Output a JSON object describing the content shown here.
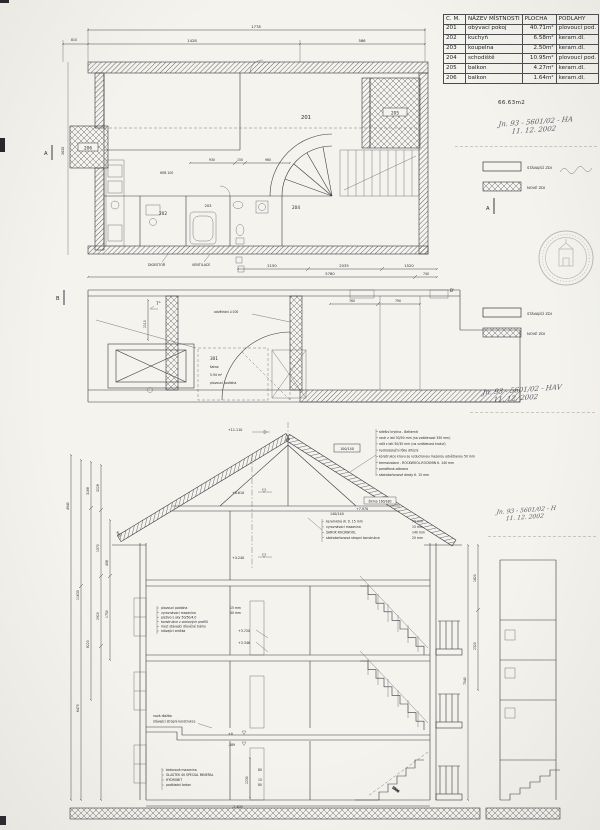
{
  "table": {
    "headers": [
      "C. M.",
      "NÁZEV MÍSTNOSTI",
      "PLOCHA",
      "PODLAHY"
    ],
    "rows": [
      {
        "no": "201",
        "name": "obývací pokoj",
        "area": "40.71m²",
        "floor": "plovoucí pod."
      },
      {
        "no": "202",
        "name": "kuchyň",
        "area": "6.58m²",
        "floor": "keram.dl."
      },
      {
        "no": "203",
        "name": "koupelna",
        "area": "2.50m²",
        "floor": "keram.dl."
      },
      {
        "no": "204",
        "name": "schodiště",
        "area": "10.95m²",
        "floor": "plovoucí pod."
      },
      {
        "no": "205",
        "name": "balkon",
        "area": "4.27m²",
        "floor": "keram.dl."
      },
      {
        "no": "206",
        "name": "balkon",
        "area": "1.64m²",
        "floor": "keram.dl."
      }
    ],
    "total": "66.63m2"
  },
  "legend": {
    "existing": "STÁVAJÍCÍ ZDI",
    "new": "NOVÉ ZDI"
  },
  "notes": {
    "hw1a": "Jn. 93 - 5601/02 - HA",
    "hw1b": "11. 12. 2002",
    "hw2a": "Jn. 93 - 5601/02 - HAV",
    "hw2b": "11. 12. 2002",
    "hw3a": "Jn. 93 - 5601/02 - H",
    "hw3b": "11. 12. 2002"
  },
  "plan1": {
    "rooms": {
      "r201": "201",
      "r202": "202",
      "r203": "203",
      "r204": "204",
      "r205": "205",
      "r206": "206"
    },
    "labels": {
      "digestor": "DIGESTOŘ",
      "ventilace": "VENTILACE",
      "heb": "HEB 100"
    },
    "dims": {
      "top1": "1778",
      "top2a": "1428",
      "top2b": "586",
      "left_top": "810",
      "left_v": "1620",
      "i1": "930",
      "i2": "150",
      "i3": "960",
      "b1": "2150",
      "b2": "2035",
      "b3": "1520",
      "b4": "5780",
      "b5": "740"
    },
    "marker_a": "A"
  },
  "plan2": {
    "slope": "7°",
    "vent": "odvětrání ∅100",
    "room": {
      "no": "301",
      "name": "šatna",
      "area": "5.94 m²",
      "floor": "plovoucí podlaha"
    },
    "dims": {
      "t1": "760",
      "t2": "790",
      "v1": "2110"
    },
    "marker_b": "B",
    "marker_b2": "B'"
  },
  "section": {
    "elev_top": "+11.110",
    "rafter": "100/140",
    "roof_notes": [
      "střešní krytina - Betternit",
      "rastr z latí 30/50 mm (na vzdálenost 350 mm)",
      "rošt z latí 50/30 mm (na vzdálenost krokví)",
      "hydroizolační fólie difúzní",
      "konstrukce krovu se vzduchovou mezerou odvětranou 50 mm",
      "termoizolace - ROCKWOOL-ROCKMIN tl. 140 mm",
      "parotěsná zábrana",
      "sádrokartonové desky tl. 15 mm"
    ],
    "elev_attic": "+8.610",
    "beam": "140/140",
    "elev_beam": "+7.970",
    "skew": "šikmo 160/180",
    "mid_notes": [
      "keramická dl. tl. 15 mm",
      "vyrovnávací mazanina",
      "ŠAROX ROCKWOOL",
      "sádrokartonová stropní konstrukce"
    ],
    "mid_vals": [
      "70 mm",
      "15 mm",
      "140 mm",
      "20 mm"
    ],
    "elev_lvl2": "+4.240",
    "floor_notes": [
      "plovoucí podlaha",
      "vyrovnávací mazanina",
      "pletivo s oky 50/50/4.0",
      "konstrukce z ocelových profilů",
      "mezi stávající dřevěné trámy",
      "stávající omítka"
    ],
    "floor_vals": [
      "15 mm",
      "40 mm"
    ],
    "elev_f1": "+3.720",
    "elev_f2": "+3.346",
    "slab_notes": [
      "nová dlažba",
      "stávající stropní konstrukce"
    ],
    "elev_zero": "±0",
    "elev_neg": "-389",
    "base_notes": [
      "betonová mazanina",
      "GLASTEK 40 SPECIAL MINERAL",
      "HYDROBIT",
      "podkladní beton"
    ],
    "base_vals": [
      "80",
      "",
      "15",
      "80"
    ],
    "elev_base": "-2.400",
    "dim_base": "2230",
    "stair_dim": "2500",
    "roof_dim": "960",
    "dims_left": [
      "4940",
      "11635",
      "6470",
      "3168",
      "8220",
      "3228",
      "1570",
      "2920",
      "458",
      "1750"
    ],
    "dims_right": [
      "1820",
      "2320",
      "7540"
    ]
  }
}
